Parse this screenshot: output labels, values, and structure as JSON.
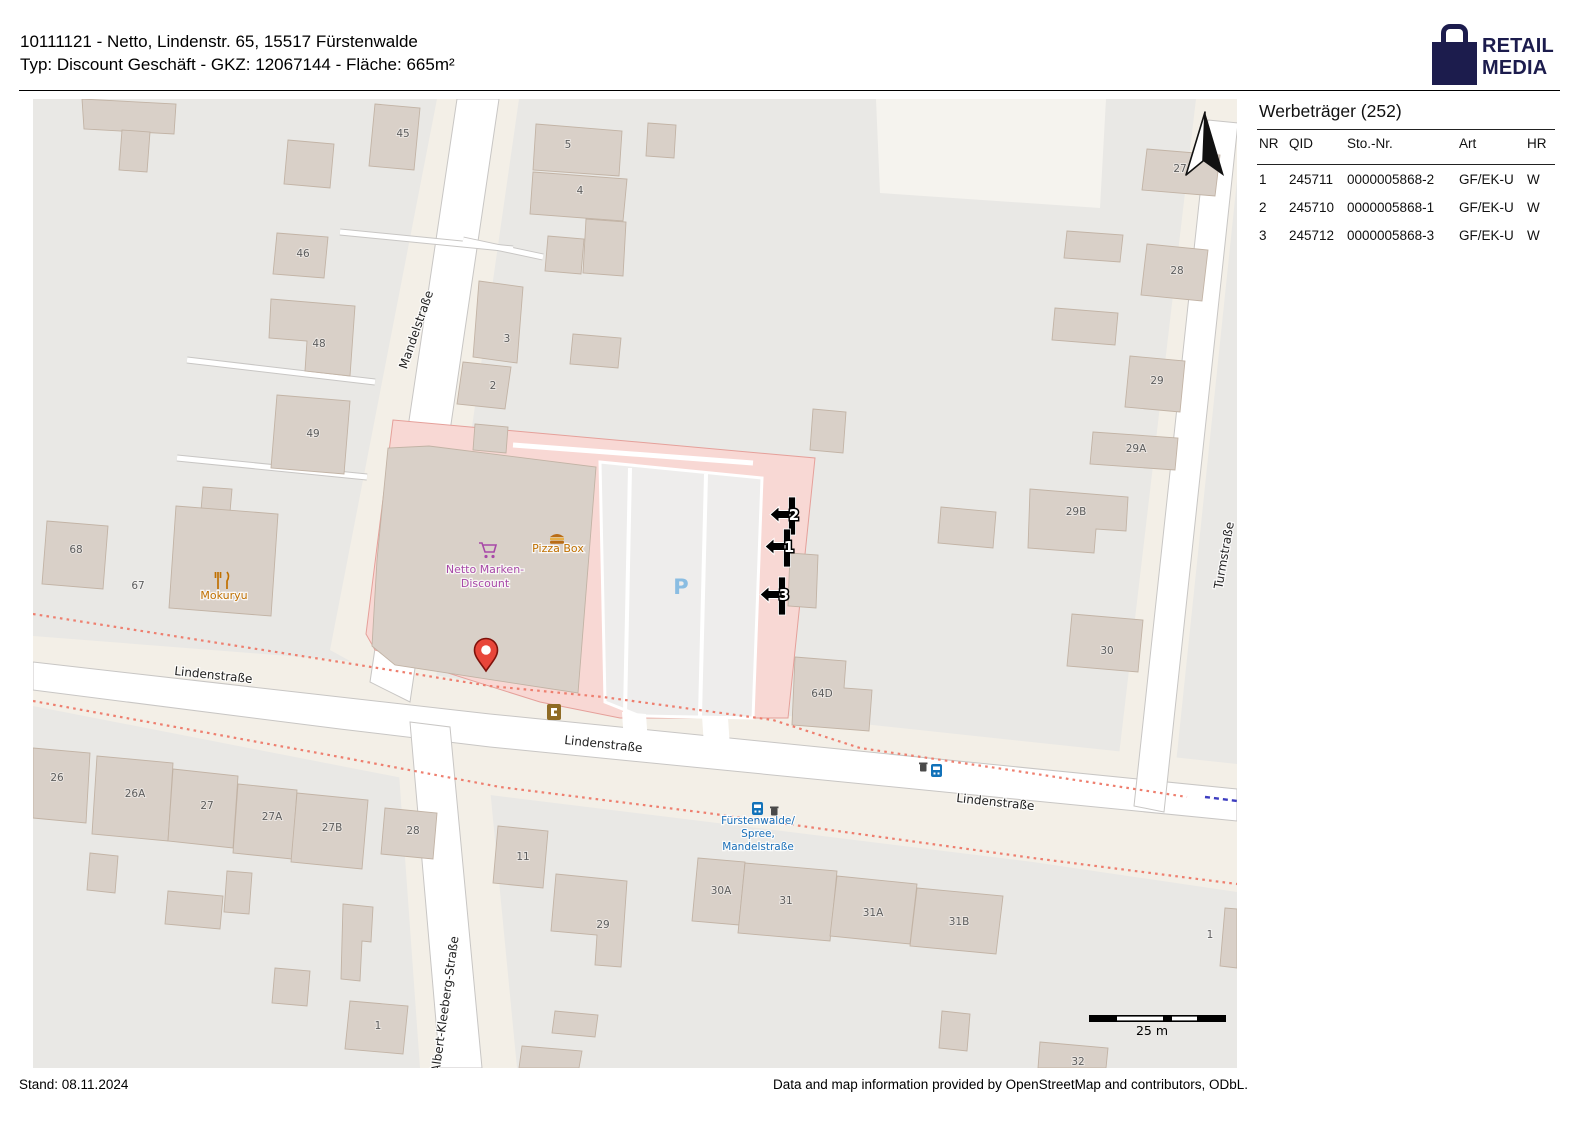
{
  "header": {
    "line1": "10111121 - Netto, Lindenstr. 65, 15517 Fürstenwalde",
    "line2": "Typ: Discount Geschäft - GKZ: 12067144 - Fläche: 665m²",
    "logo_line1": "RETAIL",
    "logo_line2": "MEDIA",
    "logo_color": "#1c1c4d"
  },
  "panel": {
    "title": "Werbeträger (252)",
    "columns": [
      "NR",
      "QID",
      "Sto.-Nr.",
      "Art",
      "HR"
    ],
    "rows": [
      [
        "1",
        "245711",
        "0000005868-2",
        "GF/EK-U",
        "W"
      ],
      [
        "2",
        "245710",
        "0000005868-1",
        "GF/EK-U",
        "W"
      ],
      [
        "3",
        "245712",
        "0000005868-3",
        "GF/EK-U",
        "W"
      ]
    ]
  },
  "footer": {
    "stand": "Stand: 08.11.2024",
    "attribution": "Data and map information provided by OpenStreetMap and contributors, ODbL."
  },
  "map": {
    "scale_label": "25 m",
    "parking_label": "P",
    "colors": {
      "building": "#d9d0c8",
      "retail_pink": "#f8d8d4",
      "pin_red": "#e8463a",
      "bus_blue": "#1272b9",
      "parking_blue": "#8abde2",
      "shop_purple": "#a849a8",
      "poi_orange": "#c07000",
      "footway_red": "#ee7f6f",
      "boundary_blue": "#3d3dc0"
    },
    "street_labels": [
      {
        "text": "Mandelstraße",
        "x": 420,
        "y": 331,
        "rot": -71
      },
      {
        "text": "Lindenstraße",
        "x": 213,
        "y": 679,
        "rot": 6
      },
      {
        "text": "Lindenstraße",
        "x": 603,
        "y": 748,
        "rot": 6
      },
      {
        "text": "Lindenstraße",
        "x": 995,
        "y": 806,
        "rot": 6
      },
      {
        "text": "Turmstraße",
        "x": 1228,
        "y": 556,
        "rot": -80
      },
      {
        "text": "Albert-Kleeberg-Straße",
        "x": 449,
        "y": 1005,
        "rot": -82
      }
    ],
    "house_numbers": [
      {
        "text": "45",
        "x": 403,
        "y": 137
      },
      {
        "text": "46",
        "x": 303,
        "y": 257
      },
      {
        "text": "48",
        "x": 319,
        "y": 347
      },
      {
        "text": "49",
        "x": 313,
        "y": 437
      },
      {
        "text": "3",
        "x": 507,
        "y": 342
      },
      {
        "text": "2",
        "x": 493,
        "y": 389
      },
      {
        "text": "5",
        "x": 568,
        "y": 148
      },
      {
        "text": "4",
        "x": 580,
        "y": 194
      },
      {
        "text": "68",
        "x": 76,
        "y": 553
      },
      {
        "text": "67",
        "x": 138,
        "y": 589
      },
      {
        "text": "27",
        "x": 1180,
        "y": 172
      },
      {
        "text": "28",
        "x": 1177,
        "y": 274
      },
      {
        "text": "29",
        "x": 1157,
        "y": 384
      },
      {
        "text": "29A",
        "x": 1136,
        "y": 452
      },
      {
        "text": "29B",
        "x": 1076,
        "y": 515
      },
      {
        "text": "30",
        "x": 1107,
        "y": 654
      },
      {
        "text": "64D",
        "x": 822,
        "y": 697
      },
      {
        "text": "26",
        "x": 57,
        "y": 781
      },
      {
        "text": "26A",
        "x": 135,
        "y": 797
      },
      {
        "text": "27",
        "x": 207,
        "y": 809
      },
      {
        "text": "27A",
        "x": 272,
        "y": 820
      },
      {
        "text": "27B",
        "x": 332,
        "y": 831
      },
      {
        "text": "28",
        "x": 413,
        "y": 834
      },
      {
        "text": "11",
        "x": 523,
        "y": 860
      },
      {
        "text": "29",
        "x": 603,
        "y": 928
      },
      {
        "text": "30A",
        "x": 721,
        "y": 894
      },
      {
        "text": "31",
        "x": 786,
        "y": 904
      },
      {
        "text": "31A",
        "x": 873,
        "y": 916
      },
      {
        "text": "31B",
        "x": 959,
        "y": 925
      },
      {
        "text": "1",
        "x": 378,
        "y": 1029
      },
      {
        "text": "1",
        "x": 1210,
        "y": 938
      },
      {
        "text": "32",
        "x": 1078,
        "y": 1065
      }
    ],
    "pois": [
      {
        "text": "Netto Marken-",
        "x": 485,
        "y": 573,
        "color": "#a849a8"
      },
      {
        "text": "Discount",
        "x": 485,
        "y": 587,
        "color": "#a849a8"
      },
      {
        "text": "Pizza Box",
        "x": 558,
        "y": 552,
        "color": "#c07000"
      },
      {
        "text": "Mokuryu",
        "x": 224,
        "y": 599,
        "color": "#c07000"
      }
    ],
    "bus_stop": {
      "lines": [
        "Fürstenwalde/",
        "Spree,",
        "Mandelstraße"
      ],
      "x": 758,
      "y": 824,
      "line_height": 13
    },
    "markers": [
      {
        "label": "2",
        "bx": 792,
        "by": 497
      },
      {
        "label": "1",
        "bx": 787,
        "by": 529
      },
      {
        "label": "3",
        "bx": 782,
        "by": 577
      }
    ]
  }
}
